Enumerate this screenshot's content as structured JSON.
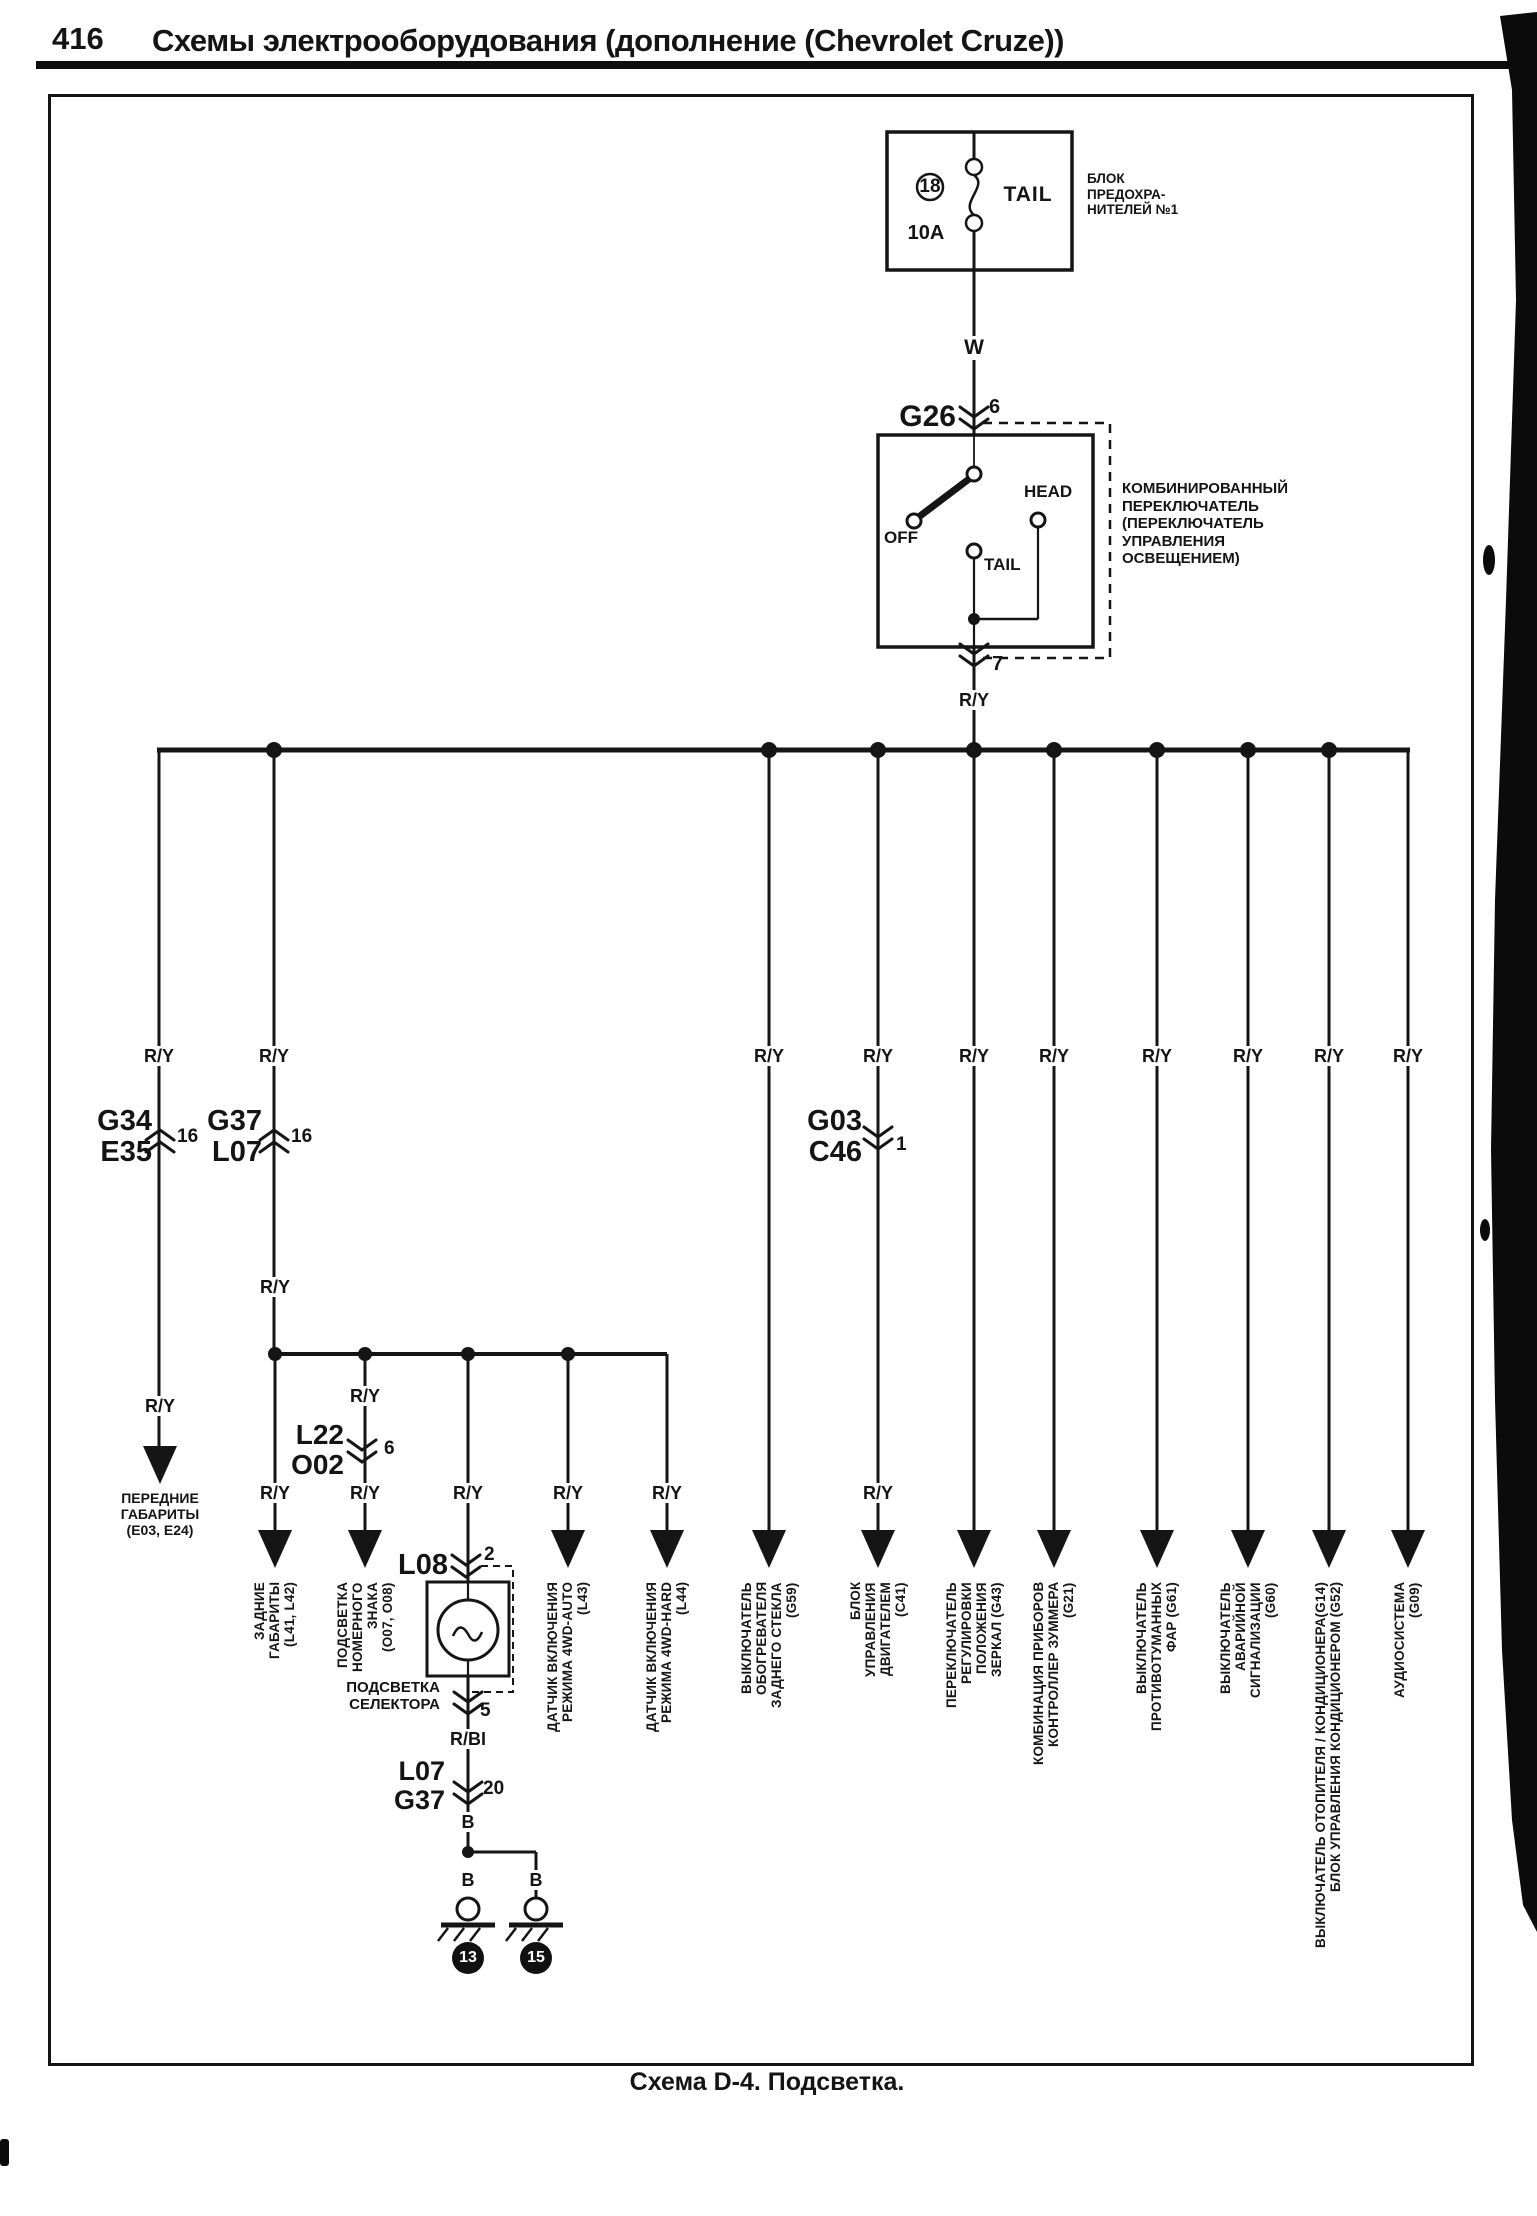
{
  "header": {
    "page_number": "416",
    "title": "Схемы электрооборудования (дополнение (Chevrolet Cruze))"
  },
  "caption": "Схема D-4. Подсветка.",
  "fuse": {
    "number": "18",
    "rating": "10A",
    "circuit": "TAIL",
    "block_label": "БЛОК\nПРЕДОХРА-\nНИТЕЛЕЙ №1"
  },
  "wire_labels": {
    "white": "W",
    "red_yellow": "R/Y",
    "red_blue": "R/BI",
    "black": "B"
  },
  "combo_switch": {
    "connector": "G26",
    "pin_in": "6",
    "pin_out": "7",
    "off": "OFF",
    "tail": "TAIL",
    "head": "HEAD",
    "label": "КОМБИНИРОВАННЫЙ\nПЕРЕКЛЮЧАТЕЛЬ\n(ПЕРЕКЛЮЧАТЕЛЬ\nУПРАВЛЕНИЯ\nОСВЕЩЕНИЕМ)"
  },
  "connectors": {
    "g34_e35": {
      "name": "G34\nE35",
      "pin": "16"
    },
    "g37_l07": {
      "name": "G37\nL07",
      "pin": "16"
    },
    "g03_c46": {
      "name": "G03\nC46",
      "pin": "1"
    },
    "l22_o02": {
      "name": "L22\nO02",
      "pin": "6"
    },
    "l08": {
      "name": "L08",
      "pin": "2"
    },
    "selector_out_pin": "5",
    "l07_g37": {
      "name": "L07\nG37",
      "pin": "20"
    }
  },
  "selector_lamp_label": "ПОДСВЕТКА\nСЕЛЕКТОРА",
  "front_lights_label": "ПЕРЕДНИЕ\nГАБАРИТЫ\n(Е03, Е24)",
  "ground_feed_wire": "B",
  "grounds": [
    {
      "wire": "B",
      "number": "13"
    },
    {
      "wire": "B",
      "number": "15"
    }
  ],
  "destinations": [
    "ЗАДНИЕ\nГАБАРИТЫ\n(L41, L42)",
    "ПОДСВЕТКА\nНОМЕРНОГО\nЗНАКА\n(O07, O08)",
    "ДАТЧИК ВКЛЮЧЕНИЯ\nРЕЖИМА 4WD-AUTO\n(L43)",
    "ДАТЧИК ВКЛЮЧЕНИЯ\nРЕЖИМА 4WD-HARD\n(L44)",
    "ВЫКЛЮЧАТЕЛЬ\nОБОГРЕВАТЕЛЯ\nЗАДНЕГО СТЕКЛА\n(G59)",
    "БЛОК\nУПРАВЛЕНИЯ\nДВИГАТЕЛЕМ\n(C41)",
    "ПЕРЕКЛЮЧАТЕЛЬ\nРЕГУЛИРОВКИ\nПОЛОЖЕНИЯ\nЗЕРКАЛ (G43)",
    "КОМБИНАЦИЯ ПРИБОРОВ\nКОНТРОЛЛЕР ЗУММЕРА\n(G21)",
    "ВЫКЛЮЧАТЕЛЬ\nПРОТИВОТУМАННЫХ\nФАР (G61)",
    "ВЫКЛЮЧАТЕЛЬ\nАВАРИЙНОЙ\nСИГНАЛИЗАЦИИ\n(G60)",
    "ВЫКЛЮЧАТЕЛЬ ОТОПИТЕЛЯ / КОНДИЦИОНЕРА(G14)\nБЛОК УПРАВЛЕНИЯ КОНДИЦИОНЕРОМ (G52)",
    "АУДИОСИСТЕМА\n(G09)"
  ]
}
